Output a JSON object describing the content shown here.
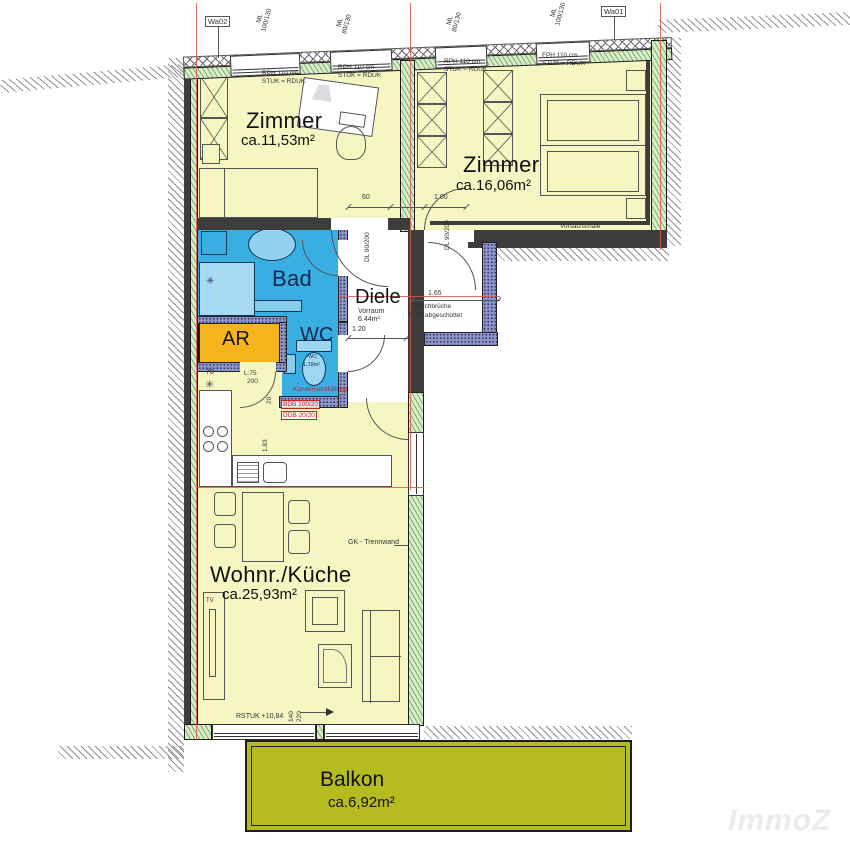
{
  "rooms": {
    "zimmer1": {
      "name": "Zimmer",
      "area": "ca.11,53m²"
    },
    "zimmer2": {
      "name": "Zimmer",
      "area": "ca.16,06m²"
    },
    "bad": {
      "name": "Bad"
    },
    "diele": {
      "name": "Diele",
      "sub": "Vorraum",
      "area": "6.44m²"
    },
    "ar": {
      "name": "AR"
    },
    "wc": {
      "name": "WC",
      "tiny": "WC",
      "tiny_area": "1,19m²"
    },
    "wohnkueche": {
      "name": "Wohnr./Küche",
      "area": "ca.25,93m²"
    },
    "balkon": {
      "name": "Balkon",
      "area": "ca.6,92m²"
    }
  },
  "wall_tags": {
    "left": "Wa02",
    "right": "Wa01"
  },
  "windows": {
    "w100": "100/130",
    "w80": "80/130",
    "ml": "ML"
  },
  "ceiling_notes": {
    "rph": "RPH 110 cm",
    "fph": "FPH 110 cm",
    "stuk": "STUK = RDUK"
  },
  "dims": {
    "d60": "60",
    "d100": "1.00",
    "dl": "DL 90/200",
    "d165": "1.65",
    "d120": "1.20",
    "d183": "1.83",
    "d70": "70",
    "l75": "L:75",
    "d200": "200",
    "d20": "20",
    "d140": "140",
    "d220": "220"
  },
  "notes": {
    "vorsatzschale": "Vorsatzschale",
    "durchbrueche": "Durchbrüche",
    "ei90": "EI 90 abgeschottet",
    "gk": "GK - Trennwand",
    "rstuk": "RSTUK +10,84",
    "tv": "TV",
    "vent": "Kondensentlüftung",
    "bdb": "BDB 100/20",
    "ddb": "DDB 20/20"
  },
  "watermark": "ImmoZ",
  "colors": {
    "room_yellow": "#f6f6c3",
    "bath_blue": "#38aee2",
    "storage_orange": "#f5b41c",
    "balcony_olive": "#b6bc20",
    "wall_green": "#dbeeca",
    "guide_red": "#e4564a"
  }
}
